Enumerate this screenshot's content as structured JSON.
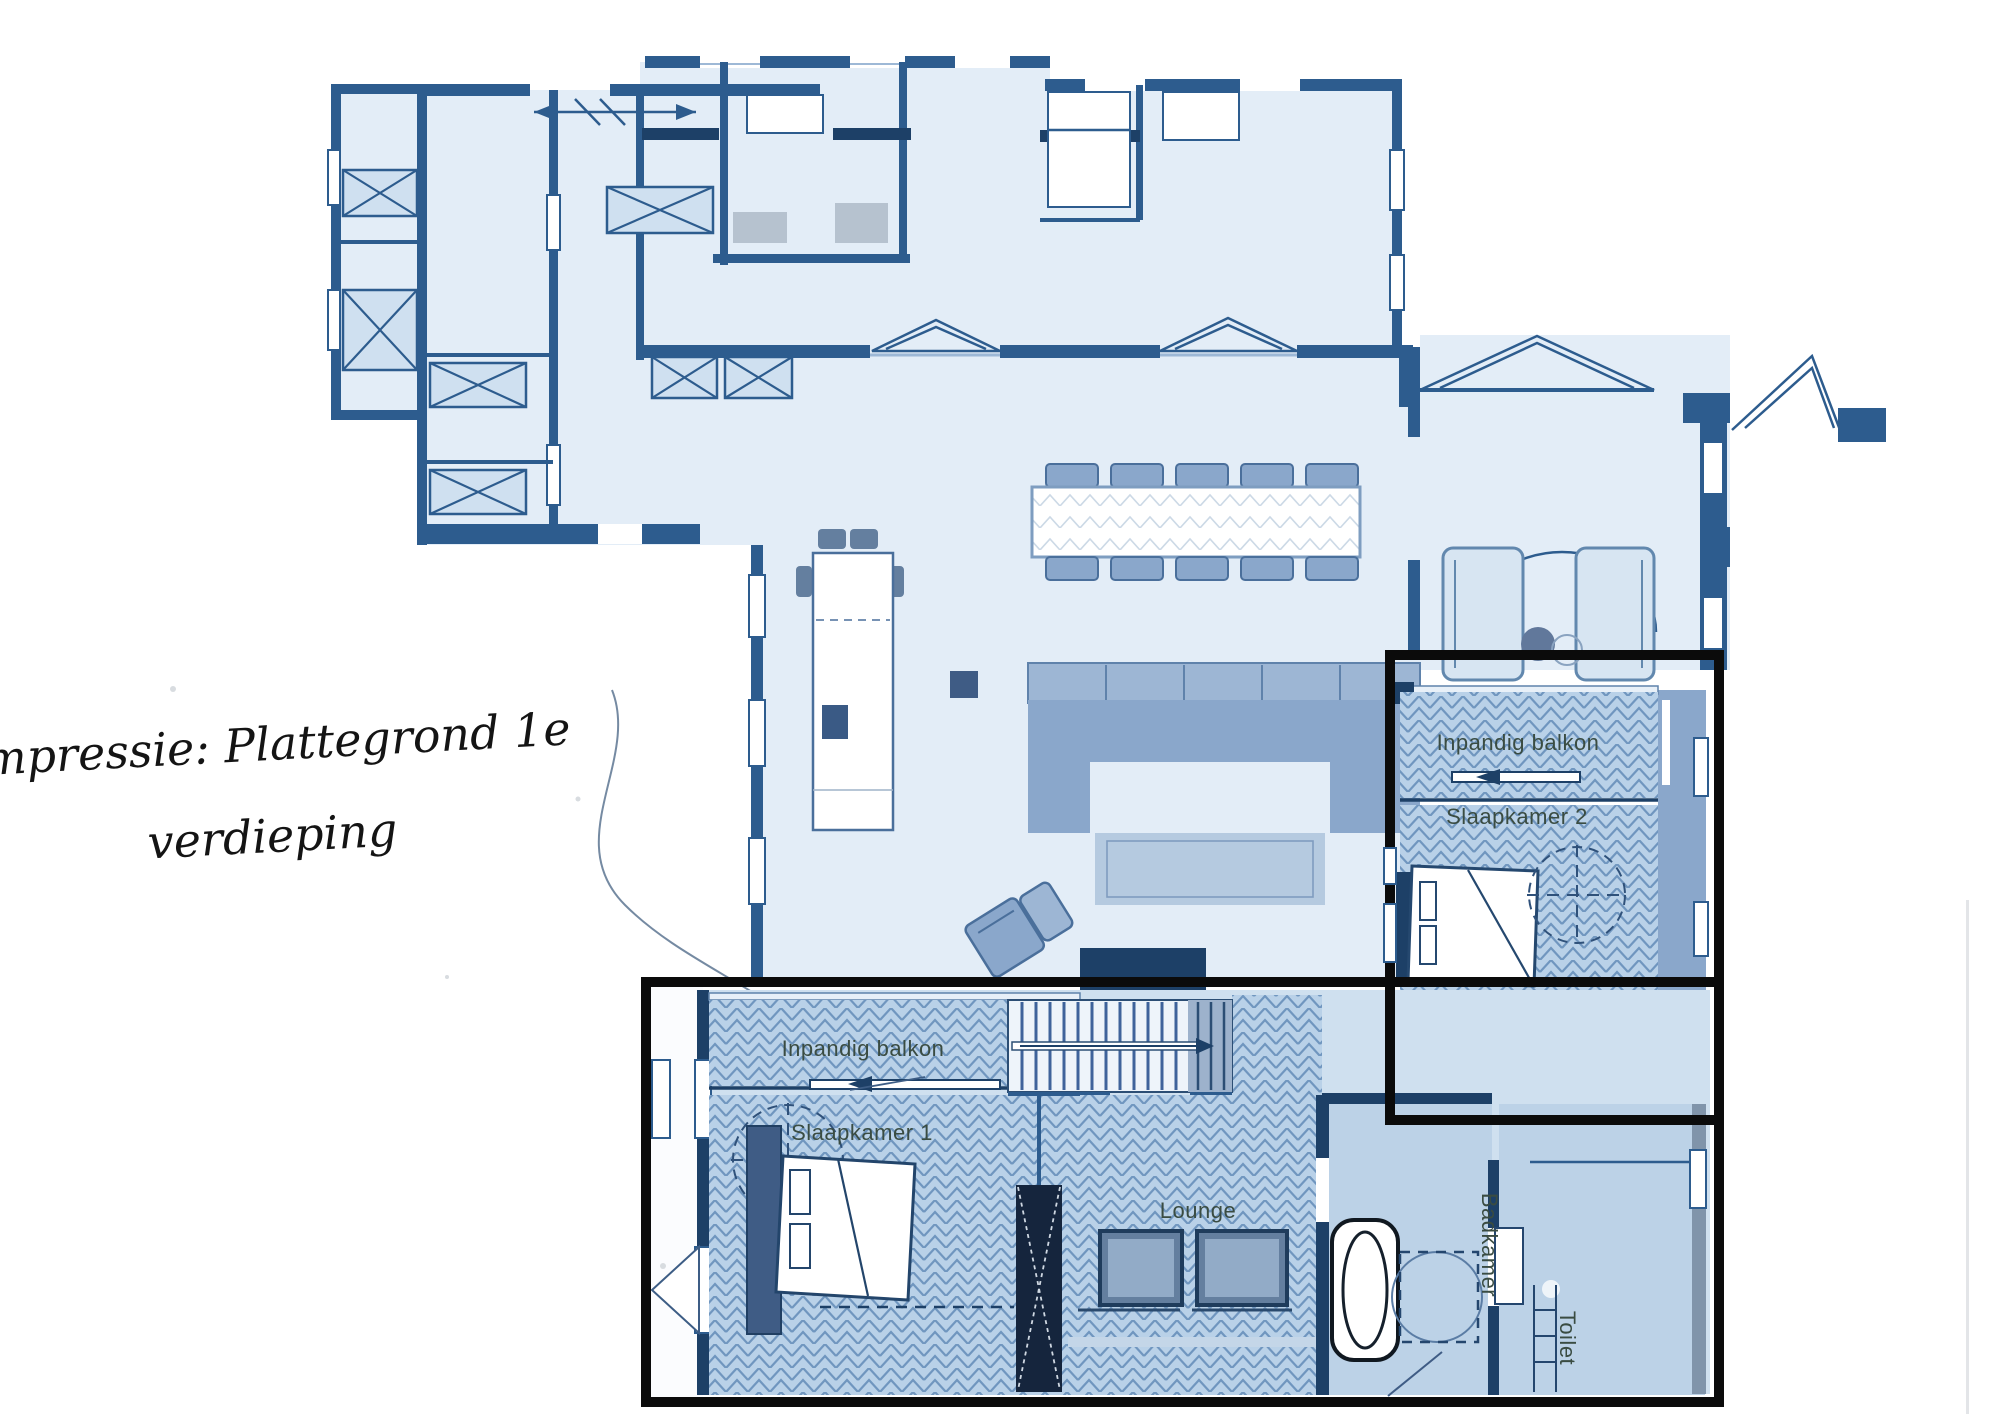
{
  "title": {
    "line1": "Impressie: Plattegrond 1e",
    "line2": "verdieping"
  },
  "plan": {
    "rooms": {
      "balcony_upper": "Inpandig balkon",
      "bedroom2": "Slaapkamer 2",
      "balcony_lower": "Inpandig balkon",
      "bedroom1": "Slaapkamer 1",
      "lounge": "Lounge",
      "bathroom": "Badkamer",
      "toilet": "Toilet"
    },
    "palette": {
      "paper": "#ffffff",
      "floor_light": "#e3edf7",
      "floor_mid": "#cfe0ef",
      "herr_fill": "#b9d1e8",
      "herr_line": "#7096bf",
      "wall": "#2d5c8e",
      "wall_dark": "#1d4067",
      "furn": "#8aa7cb",
      "furn_dark": "#647f9f",
      "outline_c": "#0b0b0b",
      "label_c": "#3a4c42",
      "title_c": "#141414"
    }
  }
}
